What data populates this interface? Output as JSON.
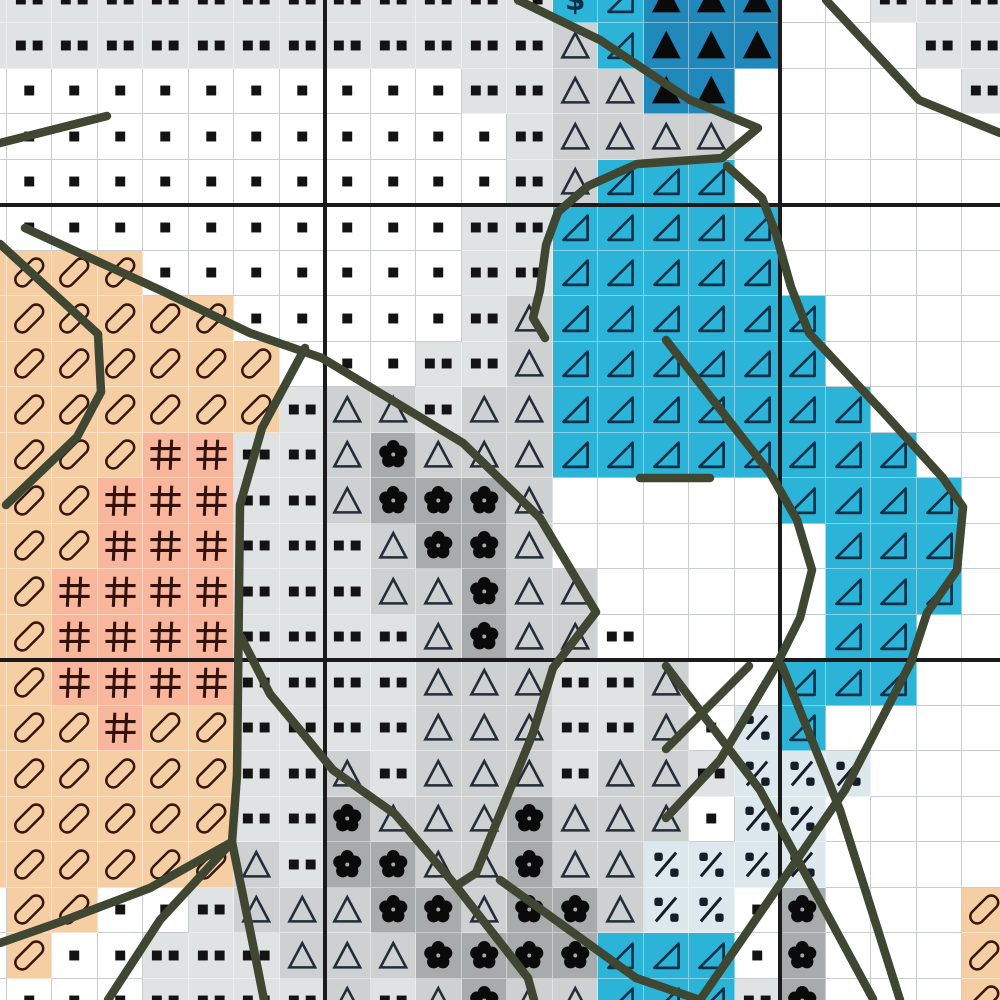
{
  "pattern": {
    "title": "cross-stitch-pattern-chart",
    "grid": {
      "cols": 23,
      "rows": 23,
      "cell_size": 45.5,
      "origin_x": -39,
      "origin_y": -22.5,
      "rows_data": [
        ":::::::::::::$rTTTww:::",
        ":::::::::::::trTTTwww::",
        "...........::ttTTwwwww:",
        "............:ttttwwwwww",
        "............:trrrwwwwww",
        "...........::rrrrrwwwww",
        "oooo.......::rrrrrwwwww",
        "oooooo.....:trrrrrrwwww",
        "ooooooow..::trrrrrrwwww",
        "ooooooo:tt:ttrrrrrrrwww",
        "oooo##::tftttrrrrrrrrww",
        "ooo###::tffftwwwwwrrrrw",
        "ooo###:::tfftwwwwwwrrrw",
        "oo####:::ttfttwwwwwrrrw",
        "oo####::::tfttdwwwwrrww",
        "oo####::::ttt::twwrrrww",
        "ooo#oo::::ttt::t.prwwww",
        "oooooo::t:ttt:tt:pppwww",
        "oooooo::ftttfttt.ppwwww",
        "oooooot:ffttfttppppwwww",
        "woo..:tttfftfftpp.fwwwo",
        "wo..:::tttffffrrr.fwwwo",
        "w...::::t:tfttrrr:fwwwo"
      ]
    },
    "palette": {
      ".": {
        "name": "single-dot-stitch",
        "bg": "#ffffff",
        "symbol": "dot1"
      },
      ":": {
        "name": "double-dot-stitch",
        "bg": "#dfe3e3",
        "symbol": "dot2"
      },
      "d": {
        "name": "double-dot-on-white",
        "bg": "#ffffff",
        "symbol": "dot2"
      },
      "w": {
        "name": "empty-stitch",
        "bg": "#ffffff",
        "symbol": null
      },
      "t": {
        "name": "open-triangle-stitch",
        "bg": "#cdd1d1",
        "symbol": "triangle"
      },
      "T": {
        "name": "filled-triangle-stitch",
        "bg": "#2088ba",
        "symbol": "filled-triangle"
      },
      "r": {
        "name": "right-triangle-stitch",
        "bg": "#2cb4d8",
        "symbol": "right-triangle"
      },
      "f": {
        "name": "florette-stitch",
        "bg": "#a7abab",
        "symbol": "florette"
      },
      "o": {
        "name": "slashed-oval-stitch",
        "bg": "#f5cfa3",
        "symbol": "oval"
      },
      "#": {
        "name": "hash-stitch",
        "bg": "#f8b79c",
        "symbol": "hash"
      },
      "p": {
        "name": "percent-stitch",
        "bg": "#dce8ee",
        "symbol": "percent"
      },
      "$": {
        "name": "dollar-stitch",
        "bg": "#2cb4d8",
        "symbol": "dollar"
      }
    },
    "symbol_colors": {
      "dot": "#131313",
      "triangle": "#232c38",
      "filled": "#0a0a0a",
      "right_triangle": "#0d3049",
      "florette": "#0a0a0a",
      "oval": "#38180c",
      "hash": "#33120b",
      "percent": "#151d28",
      "dollar": "#0d3049"
    },
    "grid_lines": {
      "minor_color": "#c9cdcd",
      "major_color": "#1b1b1b",
      "major_width": 4,
      "major_vertical_x": [
        325,
        780
      ],
      "major_horizontal_y": [
        205,
        660
      ]
    },
    "backstitch": {
      "color": "#3f4733",
      "width": 8.5,
      "polylines": [
        [
          [
            0,
            143
          ],
          [
            107,
            116
          ]
        ],
        [
          [
            0,
            244
          ],
          [
            98,
            334
          ],
          [
            101,
            392
          ],
          [
            77,
            437
          ],
          [
            6,
            505
          ]
        ],
        [
          [
            25,
            228
          ],
          [
            160,
            290
          ],
          [
            250,
            333
          ],
          [
            322,
            358
          ],
          [
            463,
            443
          ],
          [
            540,
            518
          ],
          [
            596,
            612
          ],
          [
            553,
            668
          ],
          [
            533,
            733
          ],
          [
            476,
            873
          ],
          [
            456,
            886
          ],
          [
            528,
            978
          ],
          [
            534,
            1000
          ]
        ],
        [
          [
            826,
            0
          ],
          [
            919,
            100
          ],
          [
            1000,
            133
          ]
        ],
        [
          [
            518,
            0
          ],
          [
            600,
            40
          ],
          [
            690,
            100
          ],
          [
            758,
            128
          ],
          [
            722,
            158
          ]
        ],
        [
          [
            722,
            158
          ],
          [
            637,
            164
          ],
          [
            588,
            186
          ],
          [
            558,
            212
          ],
          [
            546,
            245
          ],
          [
            540,
            290
          ],
          [
            533,
            318
          ],
          [
            545,
            338
          ]
        ],
        [
          [
            727,
            166
          ],
          [
            762,
            198
          ],
          [
            776,
            234
          ],
          [
            791,
            287
          ],
          [
            809,
            333
          ],
          [
            883,
            412
          ],
          [
            943,
            478
          ],
          [
            963,
            507
          ],
          [
            957,
            570
          ],
          [
            927,
            613
          ],
          [
            911,
            662
          ]
        ],
        [
          [
            666,
            340
          ],
          [
            770,
            473
          ],
          [
            797,
            520
          ],
          [
            812,
            570
          ],
          [
            800,
            618
          ],
          [
            776,
            666
          ],
          [
            720,
            760
          ],
          [
            666,
            818
          ]
        ],
        [
          [
            640,
            478
          ],
          [
            710,
            478
          ]
        ],
        [
          [
            749,
            666
          ],
          [
            666,
            749
          ]
        ],
        [
          [
            666,
            666
          ],
          [
            760,
            790
          ],
          [
            873,
            999
          ]
        ],
        [
          [
            911,
            662
          ],
          [
            845,
            790
          ],
          [
            745,
            935
          ],
          [
            700,
            1000
          ]
        ],
        [
          [
            782,
            666
          ],
          [
            840,
            810
          ],
          [
            900,
            1000
          ]
        ],
        [
          [
            305,
            348
          ],
          [
            262,
            428
          ],
          [
            240,
            505
          ],
          [
            237,
            775
          ],
          [
            232,
            842
          ]
        ],
        [
          [
            241,
            637
          ],
          [
            270,
            694
          ],
          [
            305,
            736
          ],
          [
            333,
            770
          ],
          [
            395,
            814
          ],
          [
            456,
            886
          ]
        ],
        [
          [
            232,
            842
          ],
          [
            150,
            888
          ],
          [
            60,
            922
          ],
          [
            0,
            943
          ]
        ],
        [
          [
            232,
            842
          ],
          [
            250,
            930
          ],
          [
            264,
            1000
          ]
        ],
        [
          [
            232,
            842
          ],
          [
            160,
            920
          ],
          [
            108,
            1000
          ]
        ],
        [
          [
            500,
            880
          ],
          [
            636,
            978
          ],
          [
            700,
            1000
          ]
        ]
      ]
    }
  }
}
